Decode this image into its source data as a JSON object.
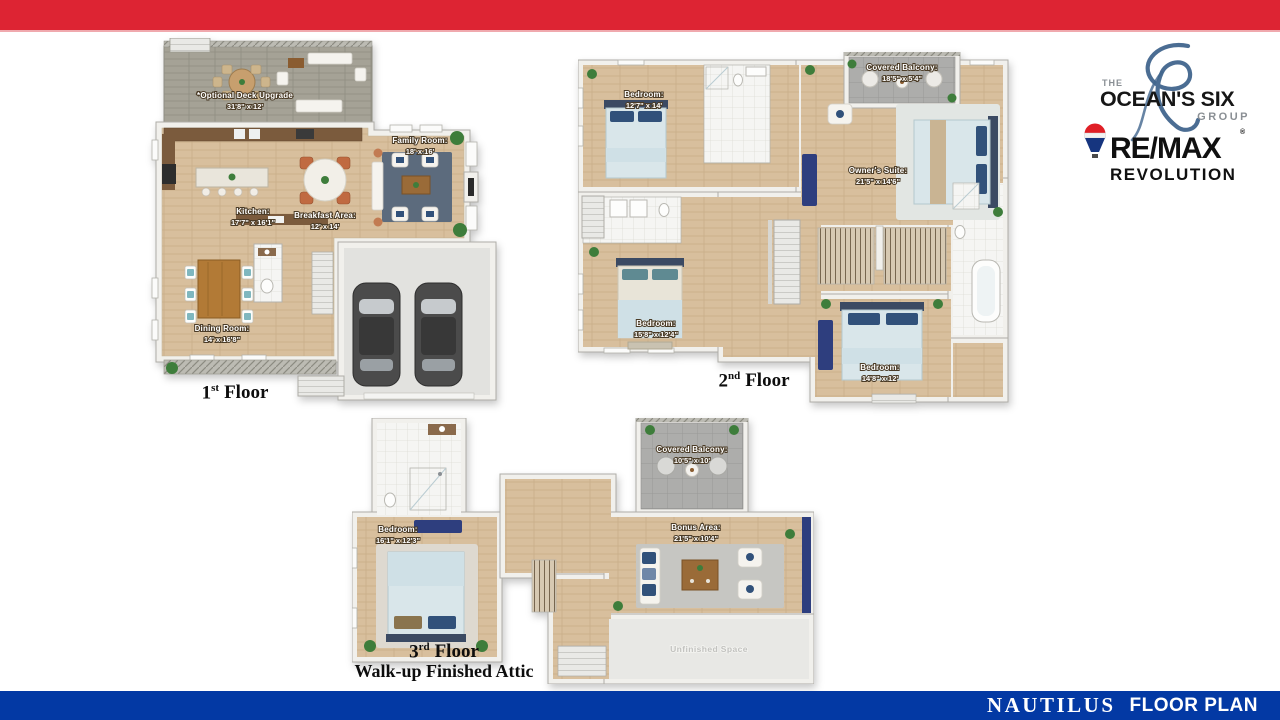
{
  "slide": {
    "top_bar_color": "#dd2433",
    "bottom_bar_color": "#0339a4",
    "background": "#ffffff"
  },
  "footer": {
    "name": "NAUTILUS",
    "label": "FLOOR PLAN"
  },
  "logos": {
    "oceans_six": {
      "the": "THE",
      "name": "OCEAN'S SIX",
      "group": "GROUP",
      "accent": "#41658d"
    },
    "remax": {
      "wordmark": "RE/MAX",
      "registered": "®",
      "sub": "REVOLUTION",
      "balloon_red": "#e01f26",
      "balloon_blue": "#16357f"
    }
  },
  "floors": [
    {
      "caption": {
        "num": "1",
        "ord": "st",
        "rest": "Floor",
        "line2": ""
      },
      "rooms": {
        "deck": {
          "name": "*Optional Deck Upgrade",
          "dims": "31'8\" x 12'"
        },
        "kitchen": {
          "name": "Kitchen:",
          "dims": "17'7\" x 16'1\""
        },
        "breakfast": {
          "name": "Breakfast Area:",
          "dims": "12' x 14'"
        },
        "family": {
          "name": "Family Room:",
          "dims": "18' x 16'"
        },
        "dining": {
          "name": "Dining Room:",
          "dims": "14' x 16'8\""
        }
      }
    },
    {
      "caption": {
        "num": "2",
        "ord": "nd",
        "rest": "Floor",
        "line2": ""
      },
      "rooms": {
        "balcony": {
          "name": "Covered Balcony:",
          "dims": "18'5\" x 5'4\""
        },
        "bedroom1": {
          "name": "Bedroom:",
          "dims": "12'7\" x 14'"
        },
        "suite": {
          "name": "Owner's Suite:",
          "dims": "21'5\" x 14'6\""
        },
        "bedroom2": {
          "name": "Bedroom:",
          "dims": "15'8\" x 12'4\""
        },
        "bedroom3": {
          "name": "Bedroom:",
          "dims": "14'8\" x 12'"
        }
      }
    },
    {
      "caption": {
        "num": "3",
        "ord": "rd",
        "rest": "Floor",
        "line2": "Walk-up Finished Attic"
      },
      "rooms": {
        "balcony": {
          "name": "Covered Balcony:",
          "dims": "10'5\" x 10'"
        },
        "bedroom": {
          "name": "Bedroom:",
          "dims": "16'1\" x 12'3\""
        },
        "bonus": {
          "name": "Bonus Area:",
          "dims": "21'5\" x 10'4\""
        },
        "unfinished": {
          "name": "Unfinished Space",
          "dims": ""
        }
      }
    }
  ]
}
